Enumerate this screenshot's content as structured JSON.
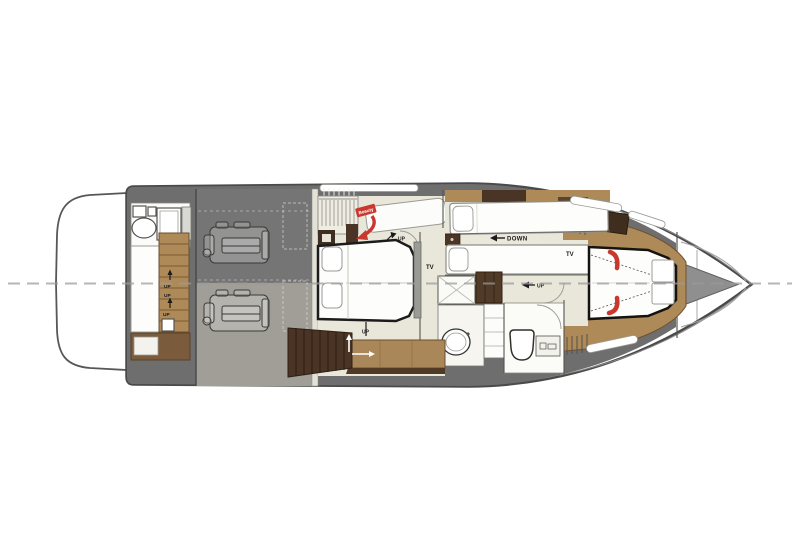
{
  "plan": {
    "labels": {
      "stern_stairs_up_1": "UP",
      "stern_stairs_up_2": "UP",
      "stern_stairs_up_3": "UP",
      "master_door_up": "UP",
      "master_companionway_up": "UP",
      "guest_down": "DOWN",
      "bow_passage_up": "UP",
      "tv_midship": "TV",
      "tv_bow": "TV",
      "beauty_station": "Beauty"
    },
    "icons": {
      "up_arrow": "up-pointing line arrow",
      "left_arrow": "left-pointing solid triangle arrow",
      "red_curved_arrow": "red curved arrow pointing down-left"
    },
    "colors": {
      "hull_outline": "#4a4a4a",
      "deck_gray": "#6e6e6e",
      "engine_room_aft": "#757575",
      "engine_room_fwd": "#a09e97",
      "floor_cream": "#e9e6da",
      "wood_tan": "#ad8a58",
      "wood_dark": "#4a3425",
      "accent_red": "#c9382f",
      "mattress_white": "#fdfdfb",
      "centerline_gray": "#9b9b9b"
    }
  }
}
